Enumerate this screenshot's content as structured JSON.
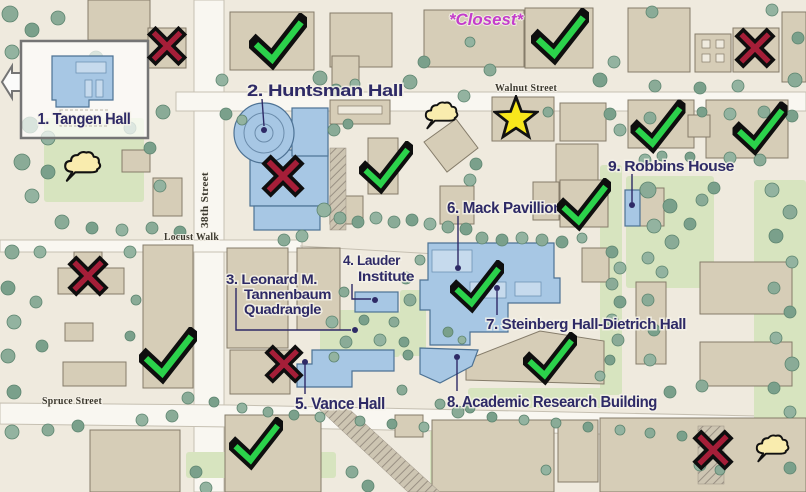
{
  "annotations": {
    "closest_note": "*Closest*"
  },
  "streets": {
    "walnut": "Walnut Street",
    "thirty_eighth": "38th Street",
    "locust": "Locust Walk",
    "spruce": "Spruce Street"
  },
  "buildings": {
    "tangen": "1. Tangen Hall",
    "huntsman": "2. Huntsman Hall",
    "tannenbaum_l1": "3. Leonard M.",
    "tannenbaum_l2": "Tannenbaum",
    "tannenbaum_l3": "Quadrangle",
    "lauder_l1": "4. Lauder",
    "lauder_l2": "Institute",
    "vance": "5. Vance Hall",
    "mack": "6. Mack Pavillion",
    "steinberg": "7. Steinberg Hall-Dietrich Hall",
    "arb": "8. Academic Research Building",
    "robbins": "9. Robbins House"
  },
  "markers": {
    "legend": {
      "check": "green-check",
      "cross": "red-x",
      "star": "yellow-star",
      "cloud": "thought-cloud"
    },
    "counts": {
      "check": 10,
      "cross": 6,
      "star": 1,
      "cloud": 3
    },
    "items": [
      {
        "type": "check",
        "x": 278,
        "y": 42,
        "s": 58
      },
      {
        "type": "check",
        "x": 560,
        "y": 37,
        "s": 58
      },
      {
        "type": "check",
        "x": 658,
        "y": 127,
        "s": 55
      },
      {
        "type": "check",
        "x": 760,
        "y": 129,
        "s": 55
      },
      {
        "type": "check",
        "x": 386,
        "y": 168,
        "s": 54
      },
      {
        "type": "check",
        "x": 584,
        "y": 205,
        "s": 54
      },
      {
        "type": "check",
        "x": 477,
        "y": 287,
        "s": 54
      },
      {
        "type": "check",
        "x": 550,
        "y": 359,
        "s": 54
      },
      {
        "type": "check",
        "x": 168,
        "y": 356,
        "s": 58
      },
      {
        "type": "check",
        "x": 256,
        "y": 444,
        "s": 54
      },
      {
        "type": "cross",
        "x": 167,
        "y": 46,
        "s": 41
      },
      {
        "type": "cross",
        "x": 755,
        "y": 48,
        "s": 42
      },
      {
        "type": "cross",
        "x": 283,
        "y": 176,
        "s": 44
      },
      {
        "type": "cross",
        "x": 88,
        "y": 276,
        "s": 42
      },
      {
        "type": "cross",
        "x": 284,
        "y": 364,
        "s": 40
      },
      {
        "type": "cross",
        "x": 713,
        "y": 450,
        "s": 42
      },
      {
        "type": "star",
        "x": 516,
        "y": 118,
        "s": 46
      },
      {
        "type": "cloud",
        "x": 82,
        "y": 166,
        "s": 42
      },
      {
        "type": "cloud",
        "x": 441,
        "y": 115,
        "s": 38
      },
      {
        "type": "cloud",
        "x": 772,
        "y": 448,
        "s": 38
      }
    ]
  },
  "colors": {
    "label_navy": "#2e2a66",
    "closest_magenta": "#c43ccb",
    "check_green": "#2bd24b",
    "cross_red": "#a51e38",
    "star_yellow": "#f8e71c",
    "cloud_yellow": "#f9ecae",
    "highlight_blue": "#a7c7e4",
    "map_base": "#efeade",
    "building_tan": "#d6cdb7"
  }
}
